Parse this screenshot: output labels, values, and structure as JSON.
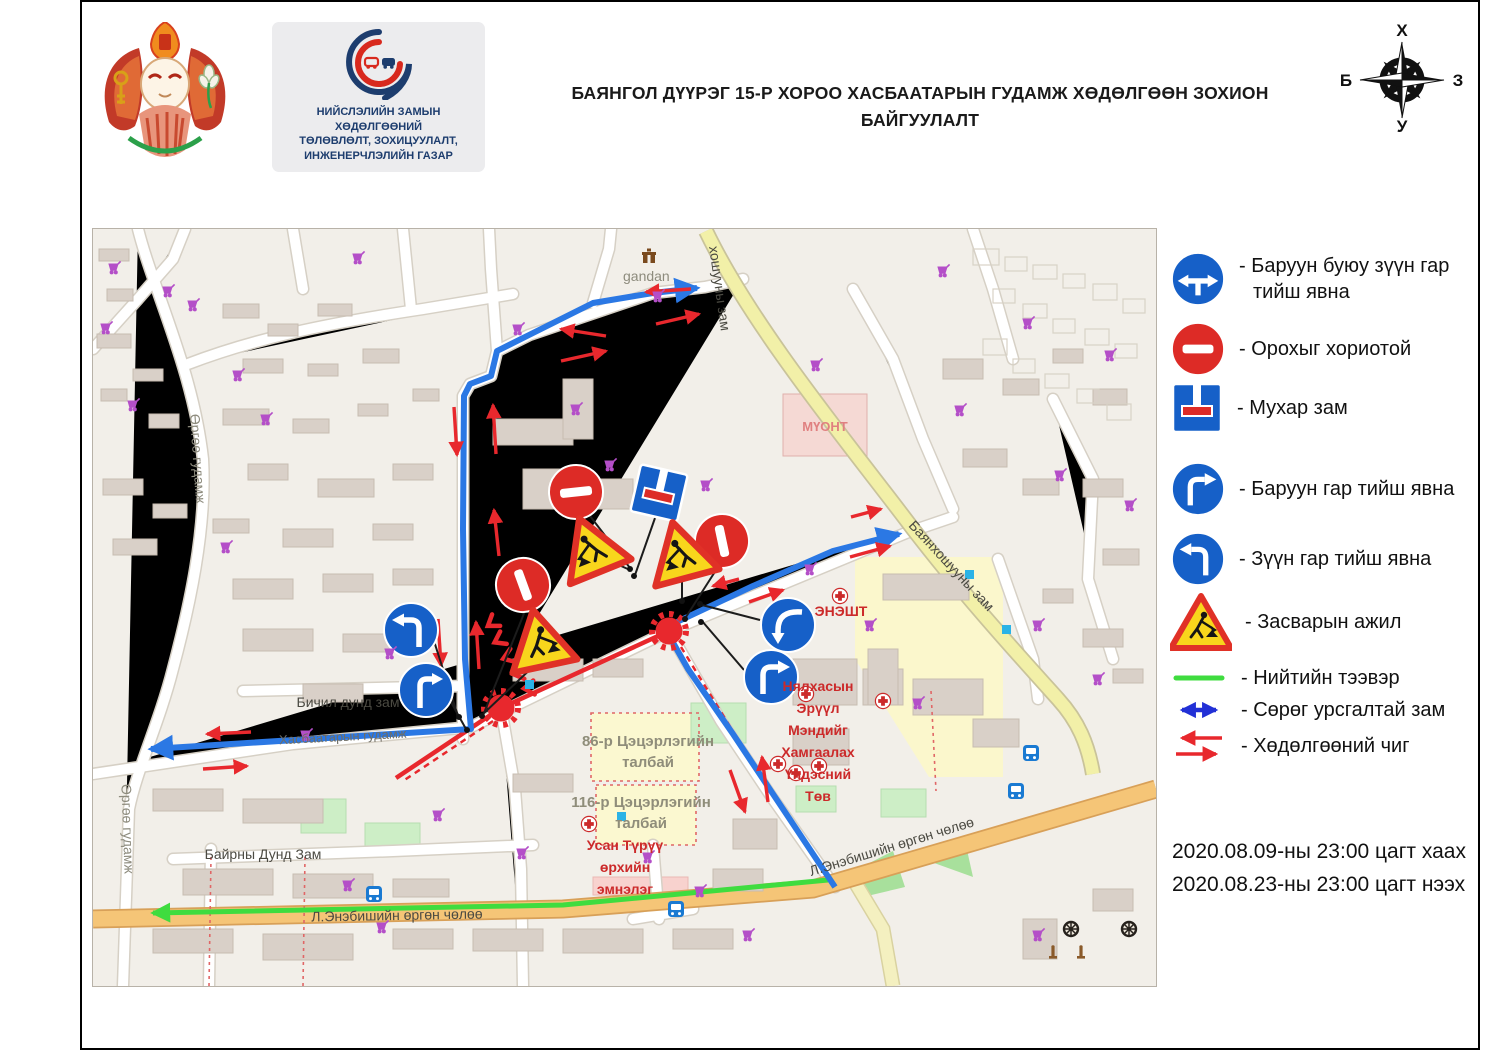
{
  "header": {
    "title": [
      "БАЯНГОЛ ДҮҮРЭГ 15-Р ХОРОО ХАСБААТАРЫН  ГУДАМЖ   ХӨДӨЛГӨӨН ЗОХИОН",
      "БАЙГУУЛАЛТ"
    ],
    "org": [
      "НИЙСЛЭЛИЙН ЗАМЫН ХӨДӨЛГӨӨНИЙ",
      "ТӨЛӨВЛӨЛТ, ЗОХИЦУУЛАЛТ,",
      "ИНЖЕНЕРЧЛЭЛИЙН ГАЗАР"
    ],
    "compass": {
      "n": "Х",
      "e": "З",
      "s": "У",
      "w": "Б"
    }
  },
  "legend": {
    "items": [
      {
        "icon": "turn-left-or-right-sign",
        "label": "- Баруун буюу зүүн гар",
        "label2": "тийш явна"
      },
      {
        "icon": "no-entry-sign",
        "label": "- Орохыг хориотой"
      },
      {
        "icon": "dead-end-sign",
        "label": "- Мухар зам"
      },
      {
        "icon": "turn-right-sign",
        "label": "- Баруун гар тийш явна"
      },
      {
        "icon": "turn-left-sign",
        "label": "- Зүүн гар тийш явна"
      },
      {
        "icon": "roadwork-sign",
        "label": "- Засварын ажил"
      },
      {
        "icon": "public-transport-line",
        "label": "- Нийтийн тээвэр"
      },
      {
        "icon": "contraflow-arrow",
        "label": "- Сөрөг урсгалтай зам"
      },
      {
        "icon": "direction-arrows",
        "label": "- Хөдөлгөөний чиг"
      }
    ],
    "schedule_line1": "2020.08.09-ны 23:00 цагт хаах",
    "schedule_line2": "2020.08.23-ны 23:00 цагт нээх"
  },
  "map": {
    "labels": {
      "gandan": "gandan",
      "khoshuu_top": "хошууны зам",
      "muont": "МҮОНТ",
      "bayankhoshuu": "Баянхошууны зам",
      "eneesht": "ЭНЭШТ",
      "nyalkhas": [
        "Нялхасын",
        "Эрүүл",
        "Мэндийг",
        "Хамгаалах",
        "Үндэсний",
        "Төв"
      ],
      "bichil": "Бичил дунд зам",
      "bairny": "Байрны Дунд Зам",
      "enebish_main": "Л.Энэбишийн өргөн чөлөө",
      "enebish_diag": "Л.Энэбишийн өргөн чөлөө",
      "urguu_top": "Өргөө гудамж",
      "urguu_bottom": "Өргөө гудамж",
      "khasbaatar": "Хасбаатарын гудамж",
      "k86": [
        "86-р Цэцэрлэгийн",
        "талбай"
      ],
      "k116": [
        "116-р Цэцэрлэгийн",
        "талбай"
      ],
      "usan": [
        "Усан Түрүү",
        "өрхийн",
        "эмнэлэг"
      ]
    }
  },
  "colors": {
    "sign_red": "#dd2b26",
    "sign_blue": "#1660c8",
    "roadwork_yellow": "#f8d61c",
    "route_blue": "#2b78e4",
    "contraflow_blue": "#2230d6",
    "arrow_red": "#e8282d",
    "transit_green": "#3fdc3f",
    "map_bg": "#f2efe9",
    "road_yellow": "#f2f0a8",
    "road_orange": "#f5c577",
    "cart_purple": "#b44fc8"
  }
}
